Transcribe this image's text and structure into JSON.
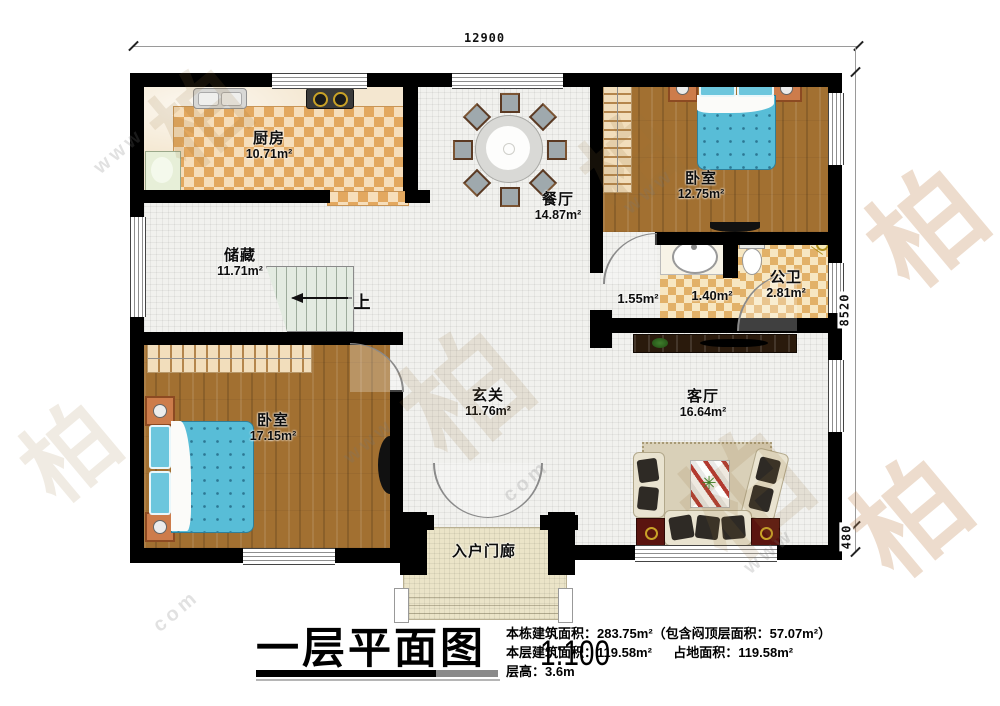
{
  "dimensions": {
    "width_top": "12900",
    "height_right": "8520",
    "porch_right": "480"
  },
  "rooms": [
    {
      "name": "厨房",
      "area": "10.71m²"
    },
    {
      "name": "餐厅",
      "area": "14.87m²"
    },
    {
      "name": "卧室",
      "area": "12.75m²"
    },
    {
      "name": "储藏",
      "area": "11.71m²"
    },
    {
      "area": "1.55m²"
    },
    {
      "area": "1.40m²"
    },
    {
      "name": "公卫",
      "area": "2.81m²"
    },
    {
      "name": "卧室",
      "area": "17.15m²"
    },
    {
      "name": "玄关",
      "area": "11.76m²"
    },
    {
      "name": "客厅",
      "area": "16.64m²"
    },
    {
      "name": "入户门廊"
    }
  ],
  "stairs": {
    "up_label": "上"
  },
  "title_block": {
    "title": "一层平面图",
    "scale": "1:100",
    "line1": "本栋建筑面积：283.75m²（包含闷顶层面积：57.07m²）",
    "line2_left": "本层建筑面积：119.58m²",
    "line2_right": "占地面积：119.58m²",
    "line3": "层高：3.6m"
  },
  "watermark": {
    "glyph": "柏",
    "fragment1": "www",
    "fragment2": "com"
  },
  "colors": {
    "wall": "#000000",
    "wood_floor": "#a27031",
    "checker_dark": "#e3a85f",
    "checker_light": "#f6debb",
    "bed_blue": "#58bdd7",
    "tile": "#f1f1ee",
    "porch_floor": "#ebe4c8",
    "end_table_red": "#5a140f"
  }
}
